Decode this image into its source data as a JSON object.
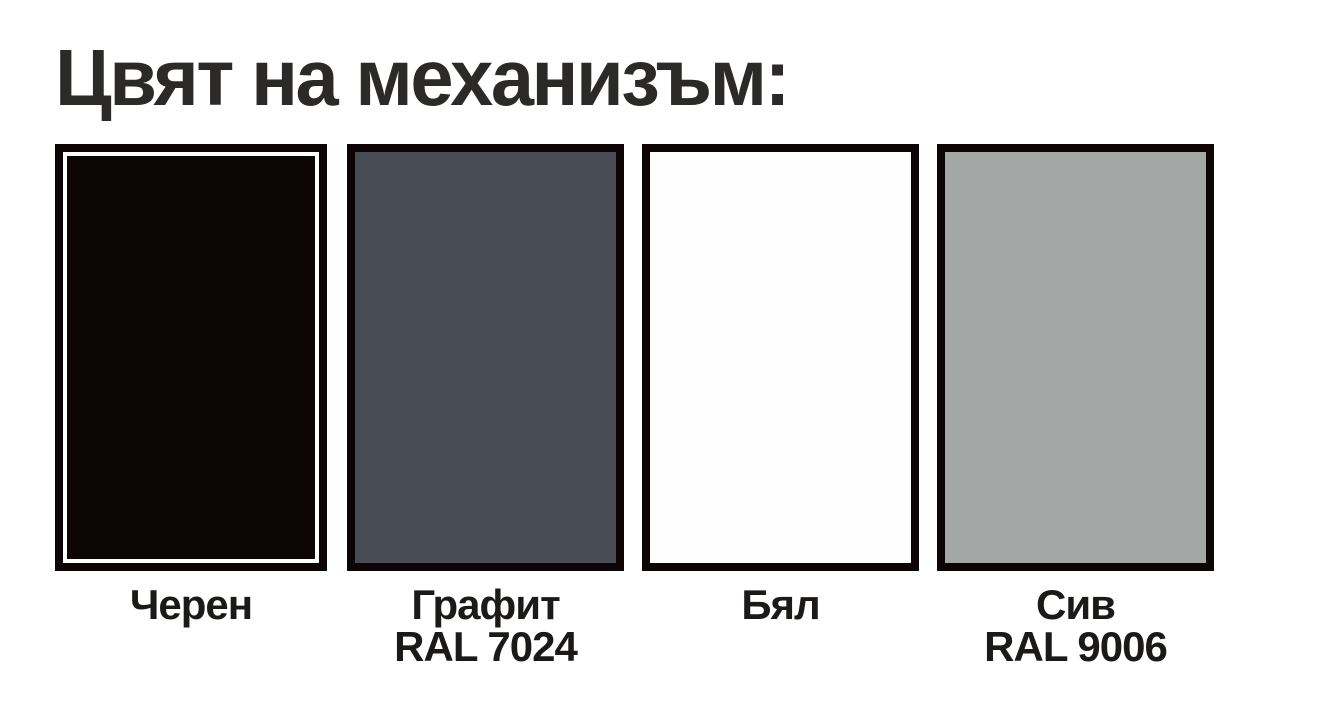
{
  "title": "Цвят на механизъм:",
  "colors": {
    "background": "#ffffff",
    "title_text": "#2b2a28",
    "label_text": "#1c1a18",
    "swatch_border": "#0c0405",
    "black_inner_stroke": "#ffffff"
  },
  "swatches": [
    {
      "id": "cheren",
      "label": "Черен",
      "ral": "",
      "fill": "#0d0506"
    },
    {
      "id": "grafit",
      "label": "Графит",
      "ral": "RAL 7024",
      "fill": "#474b53"
    },
    {
      "id": "byal",
      "label": "Бял",
      "ral": "",
      "fill": "#fefefe"
    },
    {
      "id": "siv",
      "label": "Сив",
      "ral": "RAL 9006",
      "fill": "#a3a7a6"
    }
  ]
}
